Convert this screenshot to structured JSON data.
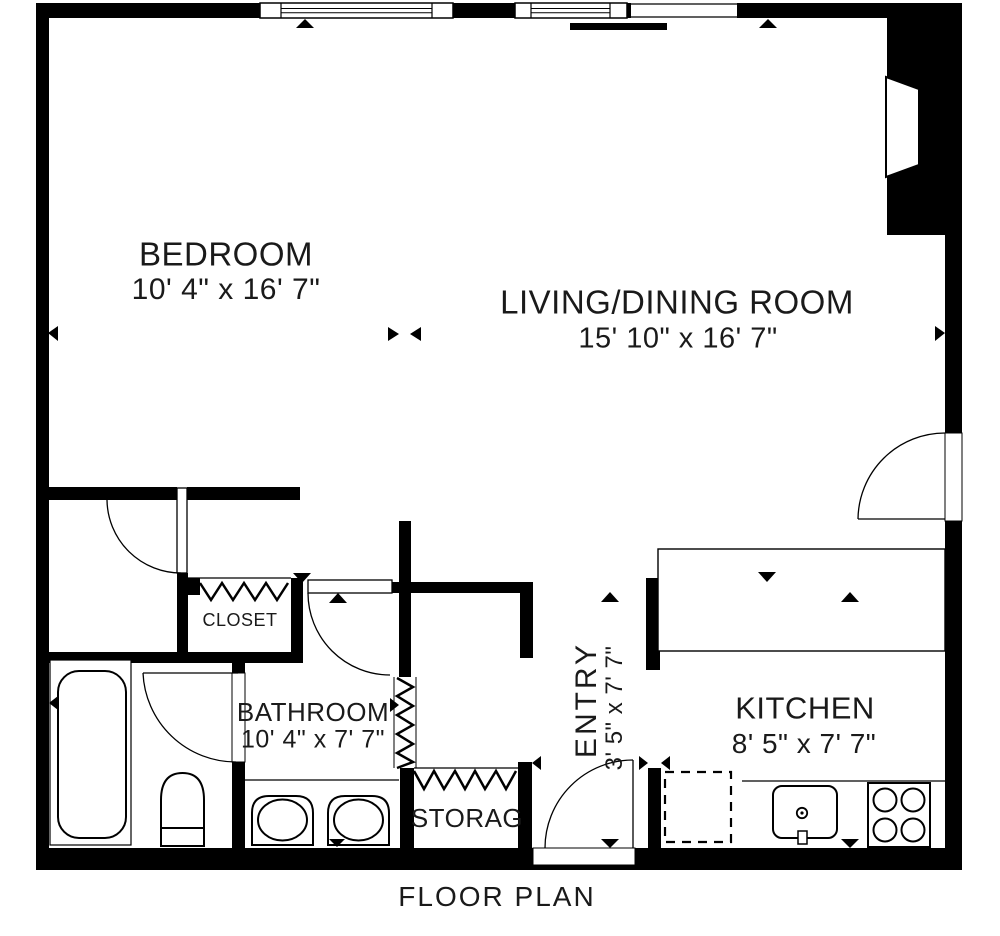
{
  "title": "FLOOR PLAN",
  "colors": {
    "wall": "#000000",
    "background": "#ffffff",
    "text": "#1a1a1a"
  },
  "rooms": {
    "bedroom": {
      "label": "BEDROOM",
      "dims": "10' 4\" x 16' 7\""
    },
    "living_dining": {
      "label": "LIVING/DINING ROOM",
      "dims": "15' 10\" x 16' 7\""
    },
    "kitchen": {
      "label": "KITCHEN",
      "dims": "8' 5\" x 7' 7\""
    },
    "bathroom": {
      "label": "BATHROOM",
      "dims": "10' 4\" x 7' 7\""
    },
    "entry": {
      "label": "ENTRY",
      "dims": "3' 5\" x 7' 7\""
    },
    "closet": {
      "label": "CLOSET"
    },
    "storage": {
      "label": "STORAG"
    }
  },
  "fixtures": [
    "bathtub",
    "toilet",
    "vanity-sink-left",
    "vanity-sink-right",
    "kitchen-sink",
    "stove",
    "refrigerator-dashed",
    "fireplace",
    "closet-rail",
    "storage-rail",
    "window",
    "sliding-door",
    "door-swing"
  ]
}
